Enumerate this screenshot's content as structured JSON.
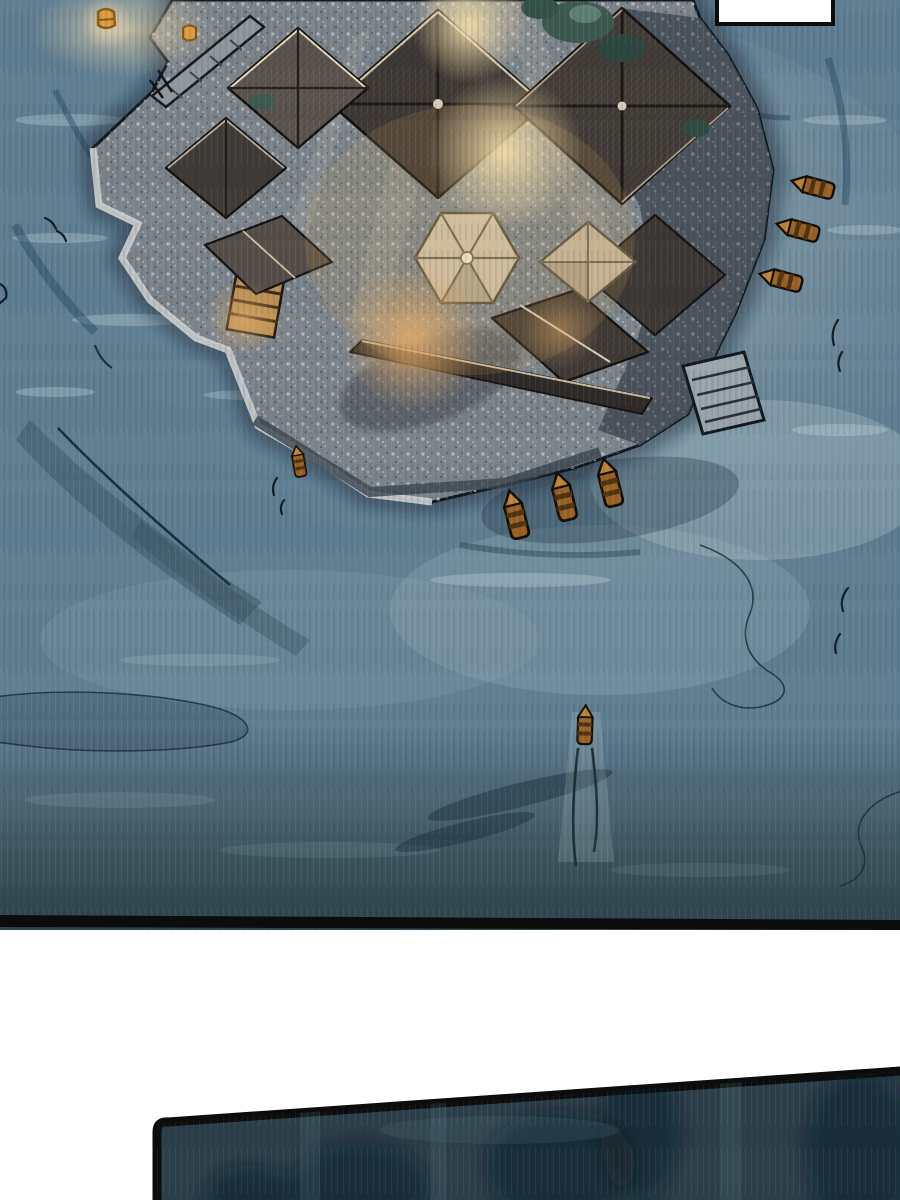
{
  "page": {
    "kind": "comic-page-crop",
    "width": 900,
    "height": 1200,
    "background": "#ffffff",
    "panel_count": 2
  },
  "speech_bubble": {
    "text": ""
  },
  "scene": {
    "panel1": {
      "subject": "aerial-night-view-temple-island-on-water",
      "boats": 8,
      "sky_lanterns": 2,
      "docks": 3,
      "pavilions": 2,
      "large_roofs": 4
    },
    "panel2": {
      "subject": "dark-water-surface"
    }
  },
  "colors": {
    "panel_border": "#0c0c0c",
    "water_base": "#5f7e92",
    "water_light": "#a7b8bc",
    "water_dark": "#33494f",
    "water_darker": "#2a3e46",
    "wave_line": "#16303c",
    "island_stone": "#7b838a",
    "island_stone_light": "#ced2d1",
    "island_rock_dark": "#454e57",
    "roof_dark": "#403a36",
    "roof_mid": "#5c544e",
    "roof_ridge": "#d9cdb9",
    "pavilion_roof": "#cec2a9",
    "glow_warm": "#f3dca8",
    "glow_orange": "#dfa968",
    "tree_green": "#3c5a50",
    "boat_brown": "#9a6224",
    "boat_dark": "#4f3310",
    "boat_bow": "#c08435",
    "lantern_orange": "#df9c3f",
    "panel2_fill": "#2c3f4a"
  }
}
